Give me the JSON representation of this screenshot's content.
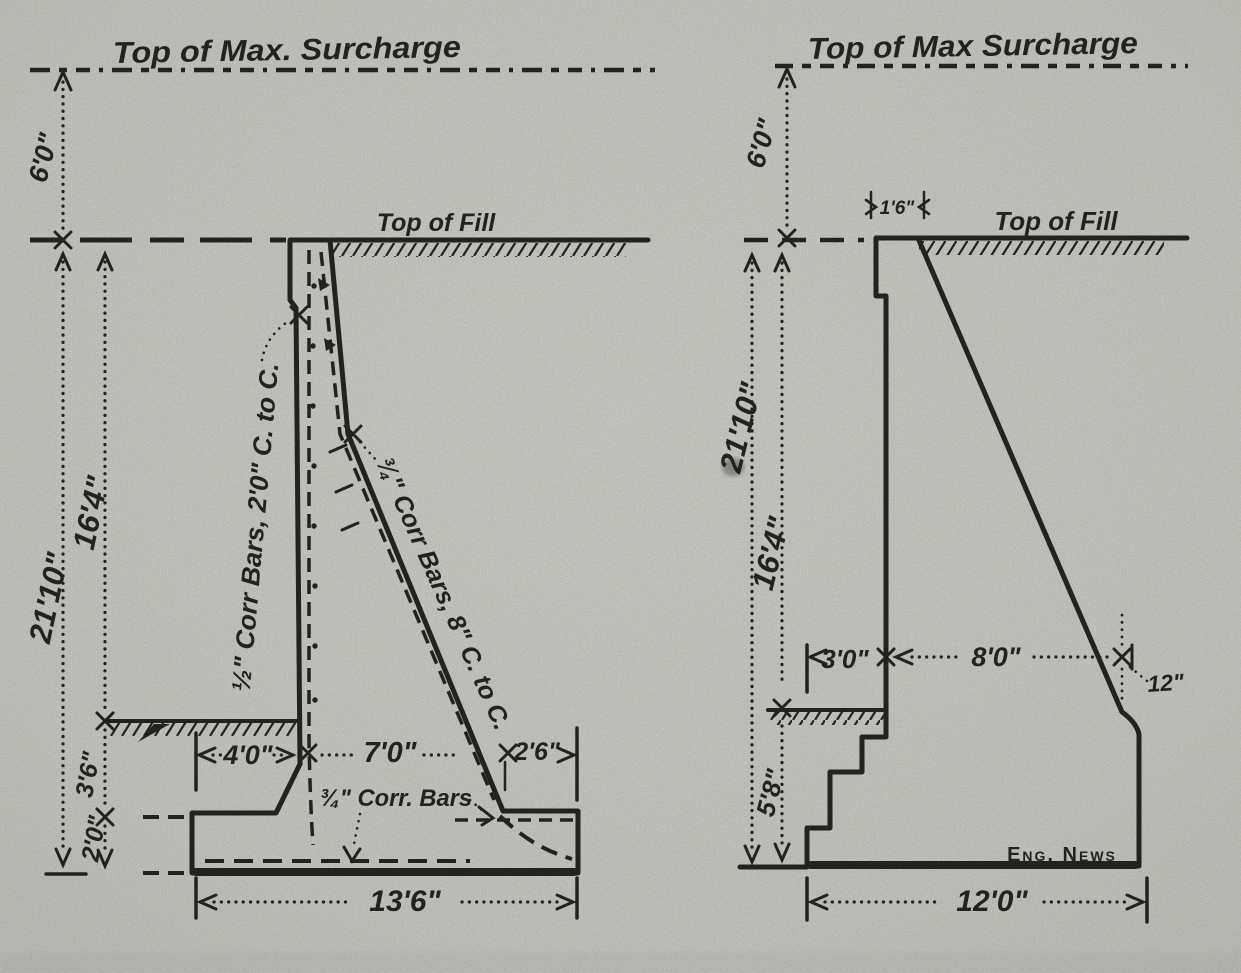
{
  "paper": {
    "background": "#dbdad6",
    "ink": "#24221f"
  },
  "left": {
    "surcharge_label": "Top of Max. Surcharge",
    "fill_label": "Top of Fill",
    "dim_surcharge_height": "6'0\"",
    "dim_total_height": "21'10\"",
    "dim_stem_height": "16'4\"",
    "dim_embedment": "3'6\"",
    "dim_footing_depth": "2'0\"",
    "dim_toe": "4'0\"",
    "dim_mid": "7'0\"",
    "dim_heel": "2'6\"",
    "dim_base_width": "13'6\"",
    "rebar_stem": "½\" Corr Bars, 2'0\" C. to C.",
    "rebar_back": "¾\" Corr Bars, 8\" C. to C.",
    "rebar_footing": "¾\" Corr. Bars"
  },
  "right": {
    "surcharge_label": "Top of Max Surcharge",
    "fill_label": "Top of Fill",
    "dim_surcharge_height": "6'0\"",
    "dim_total_height": "21'10\"",
    "dim_stem_height": "16'4\"",
    "dim_top_width": "1'6\"",
    "dim_toe_offset": "3'0\"",
    "dim_back_offset": "8'0\"",
    "dim_batter_offset": "12\"",
    "dim_base_height": "5'8\"",
    "dim_base_width": "12'0\"",
    "credit": "Eng. News"
  }
}
